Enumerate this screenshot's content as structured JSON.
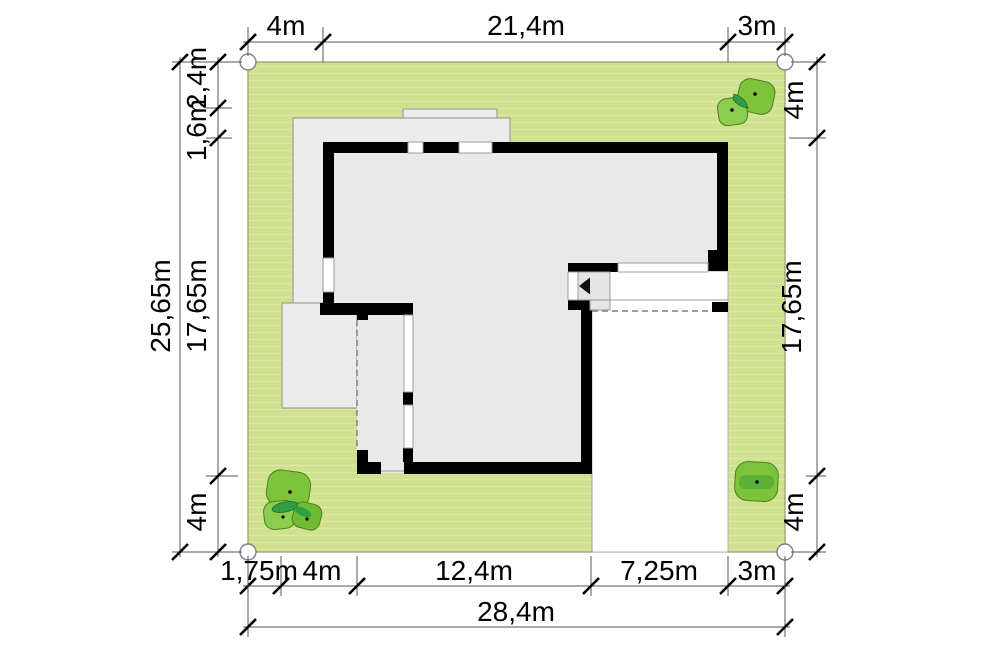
{
  "plan": {
    "type": "house-site-plan",
    "unit": "m",
    "dims": {
      "top": [
        "4m",
        "21,4m",
        "3m"
      ],
      "bottom": [
        "1,75m",
        "4m",
        "12,4m",
        "7,25m",
        "3m"
      ],
      "bottom_total": "28,4m",
      "left_total": "25,65m",
      "left": [
        "2,4m",
        "1,6m",
        "17,65m",
        "4m"
      ],
      "right": [
        "4m",
        "17,65m",
        "4m"
      ]
    },
    "plot": {
      "width_label": "28,4m",
      "height_label": "25,65m"
    },
    "colors": {
      "plot_green": "#cfe08e",
      "tree_green": "#7cc43c",
      "tree_green_light": "#8bcd4e",
      "tree_green_dark": "#2f9e45",
      "wall_black": "#000000",
      "terrace_gray": "#ebebeb",
      "floor_gray": "#e9e9e9",
      "driveway_white": "#ffffff"
    },
    "icons": {
      "entry": "entry-direction-arrow"
    }
  }
}
